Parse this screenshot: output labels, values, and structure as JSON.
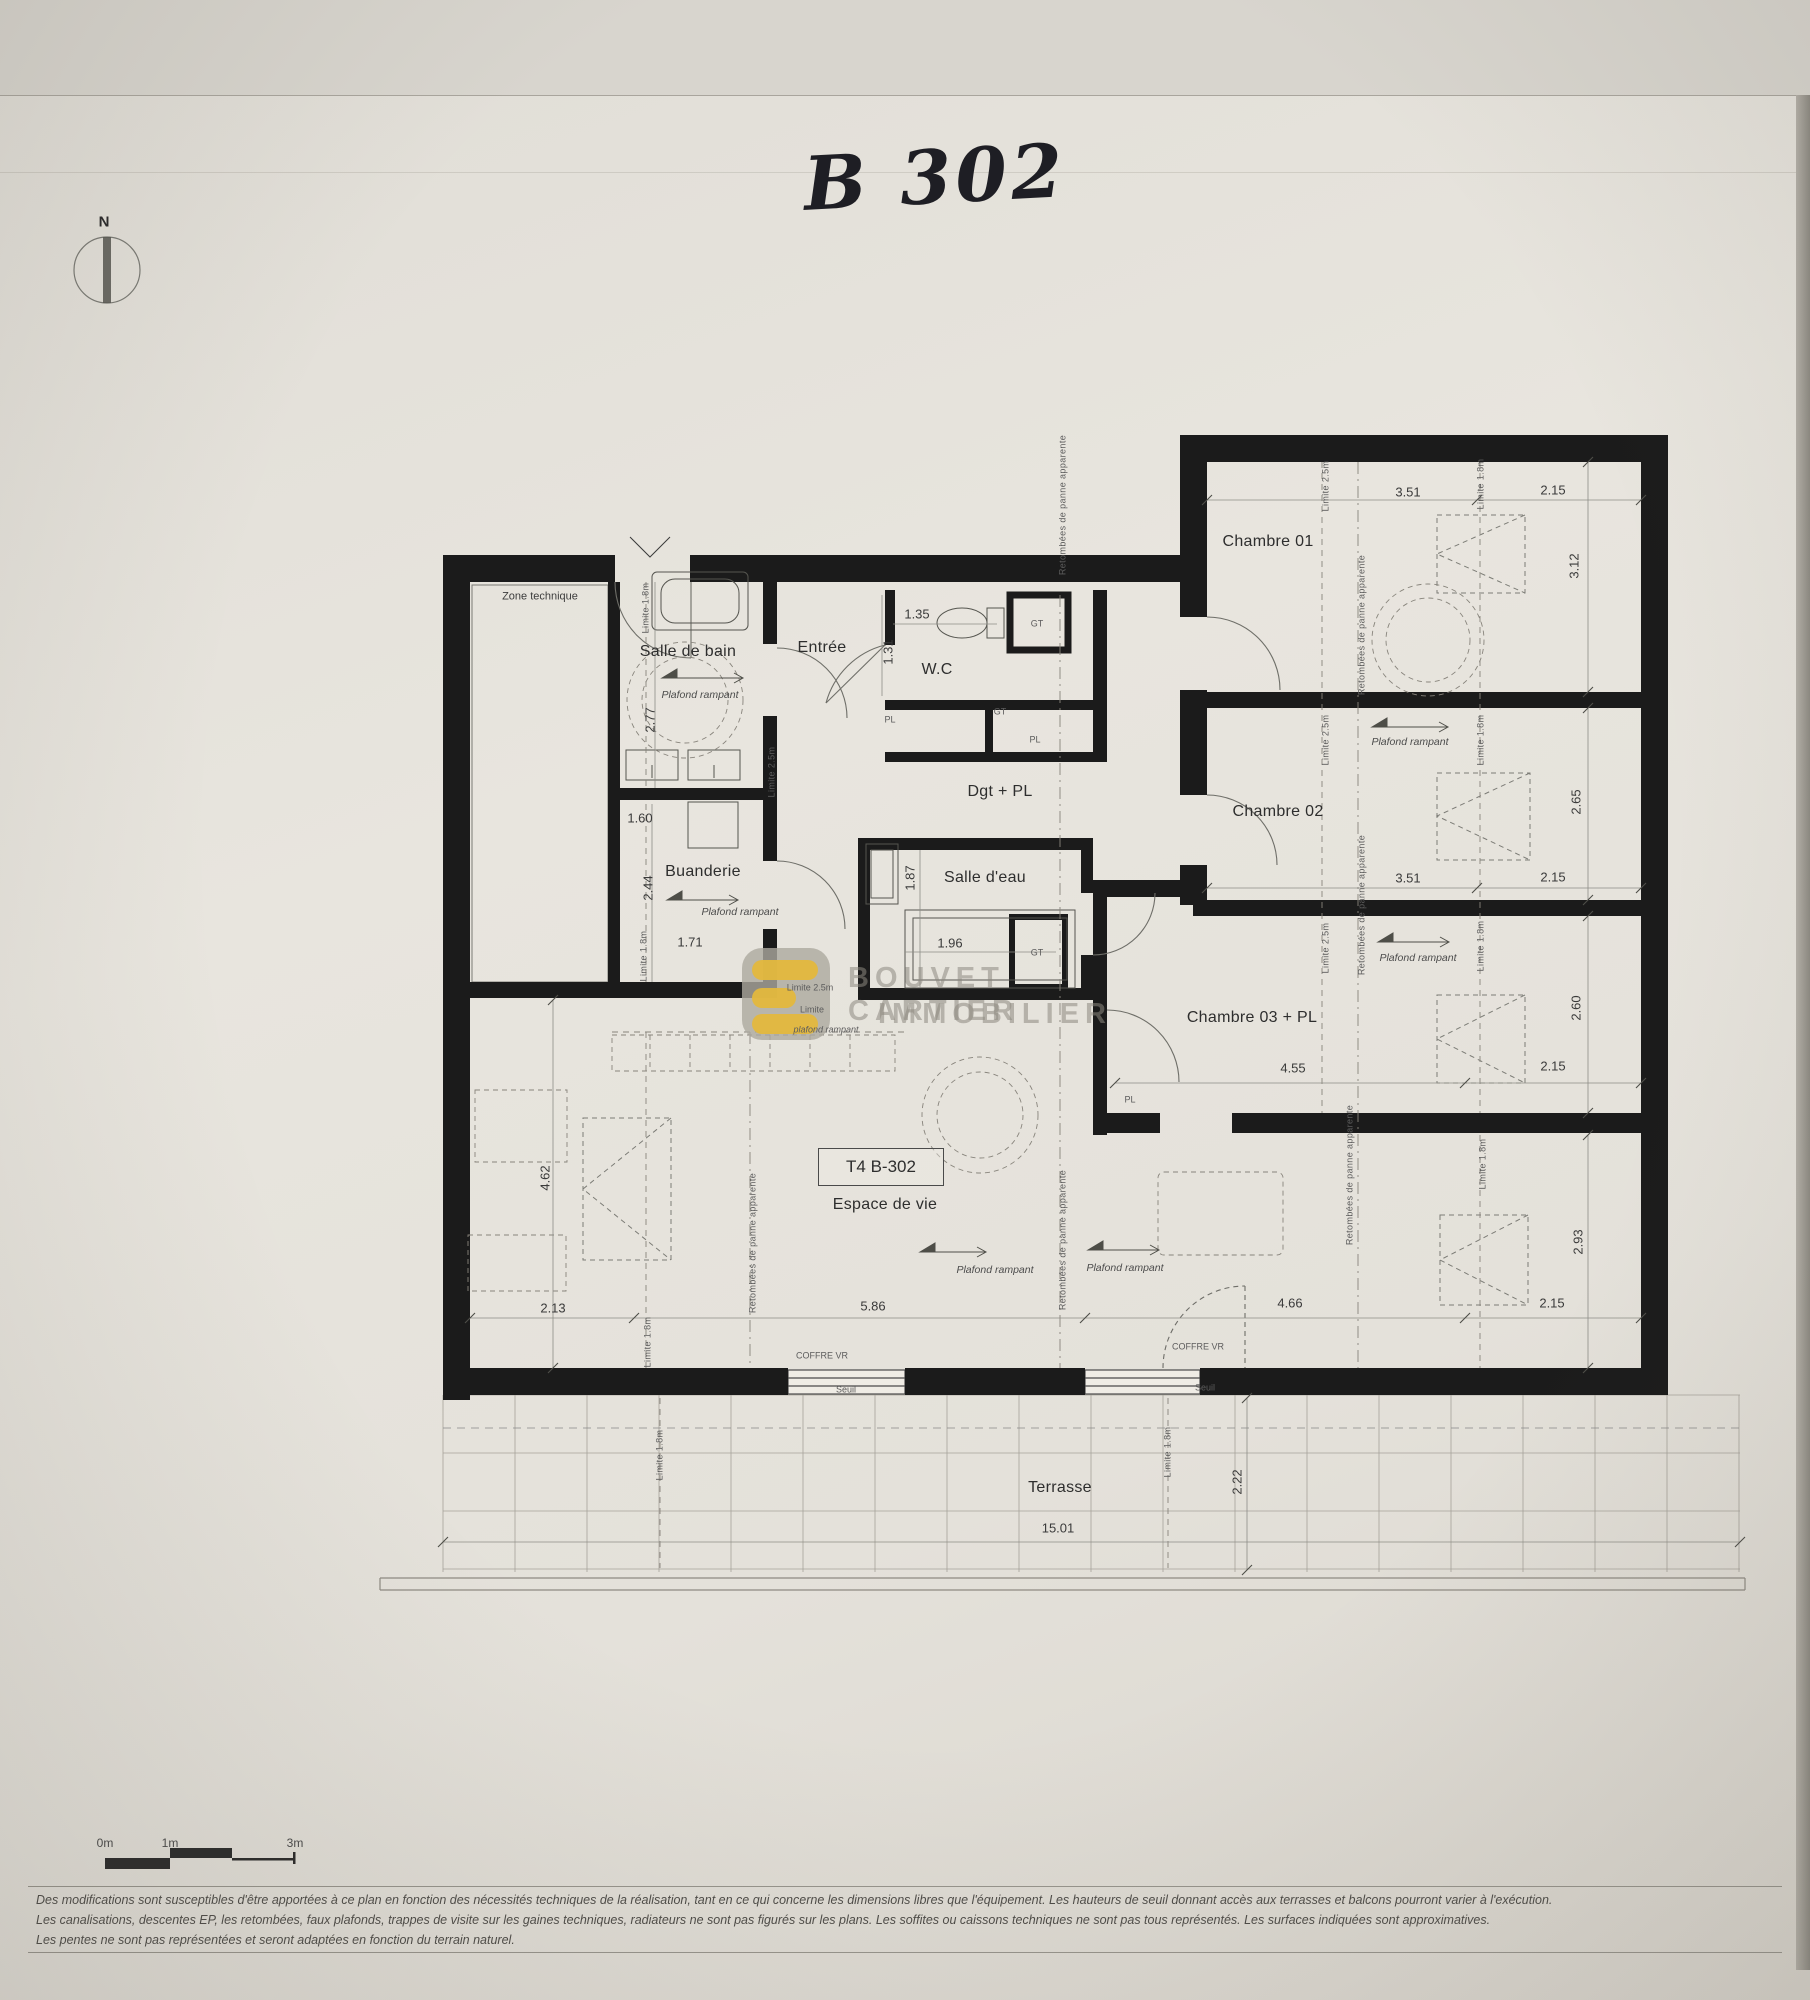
{
  "page": {
    "handwritten_unit": "B 302",
    "compass_north": "N"
  },
  "unit_box": {
    "label": "T4 B-302"
  },
  "watermark": {
    "line1": "BOUVET CARTIER",
    "line2": "IMMOBILIER"
  },
  "scalebar": {
    "zero": "0m",
    "one": "1m",
    "three": "3m"
  },
  "disclaimer": {
    "line1": "Des modifications sont susceptibles d'être apportées à ce plan en fonction des nécessités techniques de la réalisation, tant en ce qui concerne les dimensions libres que l'équipement. Les hauteurs de seuil donnant accès aux terrasses et balcons pourront varier à l'exécution.",
    "line2": "Les canalisations, descentes EP, les retombées, faux plafonds, trappes de visite sur les gaines techniques, radiateurs ne sont pas figurés sur les plans. Les soffites ou caissons techniques ne sont pas tous représentés. Les surfaces indiquées sont approximatives.",
    "line3": "Les pentes ne sont pas représentées et seront adaptées en fonction du terrain naturel."
  },
  "colors": {
    "wall": "#1b1b1b",
    "paper": "#e8e5de",
    "watermark_yellow": "#e3b83d",
    "watermark_gray": "#9a968c"
  },
  "plan": {
    "labels": [
      {
        "t": "Zone technique",
        "x": 540,
        "y": 597,
        "k": "roomsm"
      },
      {
        "t": "Salle de bain",
        "x": 688,
        "y": 652,
        "k": "room"
      },
      {
        "t": "Entrée",
        "x": 822,
        "y": 648,
        "k": "room"
      },
      {
        "t": "W.C",
        "x": 937,
        "y": 670,
        "k": "room"
      },
      {
        "t": "Dgt + PL",
        "x": 1000,
        "y": 792,
        "k": "room"
      },
      {
        "t": "Chambre 01",
        "x": 1268,
        "y": 542,
        "k": "room"
      },
      {
        "t": "Chambre 02",
        "x": 1278,
        "y": 812,
        "k": "room"
      },
      {
        "t": "Chambre 03 + PL",
        "x": 1252,
        "y": 1018,
        "k": "room"
      },
      {
        "t": "Buanderie",
        "x": 703,
        "y": 872,
        "k": "room"
      },
      {
        "t": "Salle d'eau",
        "x": 985,
        "y": 878,
        "k": "room"
      },
      {
        "t": "Espace de vie",
        "x": 885,
        "y": 1205,
        "k": "room"
      },
      {
        "t": "Terrasse",
        "x": 1060,
        "y": 1488,
        "k": "room"
      },
      {
        "t": "PL",
        "x": 890,
        "y": 720,
        "k": "tiny"
      },
      {
        "t": "GT",
        "x": 1037,
        "y": 624,
        "k": "tiny"
      },
      {
        "t": "GT",
        "x": 1000,
        "y": 712,
        "k": "tiny"
      },
      {
        "t": "PL",
        "x": 1035,
        "y": 740,
        "k": "tiny"
      },
      {
        "t": "GT",
        "x": 1037,
        "y": 953,
        "k": "tiny"
      },
      {
        "t": "PL",
        "x": 1130,
        "y": 1100,
        "k": "tiny"
      },
      {
        "t": "1.35",
        "x": 917,
        "y": 614,
        "k": "dim"
      },
      {
        "t": "1.31",
        "x": 888,
        "y": 652,
        "k": "dimv"
      },
      {
        "t": "2.77",
        "x": 650,
        "y": 720,
        "k": "dimv"
      },
      {
        "t": "1.60",
        "x": 640,
        "y": 818,
        "k": "dim"
      },
      {
        "t": "2.44",
        "x": 648,
        "y": 888,
        "k": "dimv"
      },
      {
        "t": "1.71",
        "x": 690,
        "y": 942,
        "k": "dim"
      },
      {
        "t": "1.87",
        "x": 910,
        "y": 878,
        "k": "dimv"
      },
      {
        "t": "1.96",
        "x": 950,
        "y": 943,
        "k": "dim"
      },
      {
        "t": "3.51",
        "x": 1408,
        "y": 492,
        "k": "dim"
      },
      {
        "t": "2.15",
        "x": 1553,
        "y": 490,
        "k": "dim"
      },
      {
        "t": "3.12",
        "x": 1574,
        "y": 566,
        "k": "dimv"
      },
      {
        "t": "2.65",
        "x": 1576,
        "y": 802,
        "k": "dimv"
      },
      {
        "t": "3.51",
        "x": 1408,
        "y": 878,
        "k": "dim"
      },
      {
        "t": "2.15",
        "x": 1553,
        "y": 877,
        "k": "dim"
      },
      {
        "t": "2.60",
        "x": 1576,
        "y": 1008,
        "k": "dimv"
      },
      {
        "t": "2.15",
        "x": 1553,
        "y": 1066,
        "k": "dim"
      },
      {
        "t": "4.55",
        "x": 1293,
        "y": 1068,
        "k": "dim"
      },
      {
        "t": "2.93",
        "x": 1578,
        "y": 1242,
        "k": "dimv"
      },
      {
        "t": "2.15",
        "x": 1552,
        "y": 1303,
        "k": "dim"
      },
      {
        "t": "4.62",
        "x": 545,
        "y": 1178,
        "k": "dimv"
      },
      {
        "t": "2.13",
        "x": 553,
        "y": 1308,
        "k": "dim"
      },
      {
        "t": "5.86",
        "x": 873,
        "y": 1306,
        "k": "dim"
      },
      {
        "t": "4.66",
        "x": 1290,
        "y": 1303,
        "k": "dim"
      },
      {
        "t": "15.01",
        "x": 1058,
        "y": 1528,
        "k": "dim"
      },
      {
        "t": "2.22",
        "x": 1237,
        "y": 1482,
        "k": "dimv"
      },
      {
        "t": "Plafond rampant",
        "x": 700,
        "y": 695,
        "k": "note"
      },
      {
        "t": "Plafond rampant",
        "x": 740,
        "y": 912,
        "k": "note"
      },
      {
        "t": "Plafond rampant",
        "x": 1410,
        "y": 742,
        "k": "note"
      },
      {
        "t": "Plafond rampant",
        "x": 1418,
        "y": 958,
        "k": "note"
      },
      {
        "t": "Plafond rampant",
        "x": 995,
        "y": 1270,
        "k": "note"
      },
      {
        "t": "Plafond rampant",
        "x": 1125,
        "y": 1268,
        "k": "note"
      },
      {
        "t": "Limite 1.8m",
        "x": 646,
        "y": 608,
        "k": "tinyv"
      },
      {
        "t": "Limite 2.5m",
        "x": 772,
        "y": 772,
        "k": "tinyv"
      },
      {
        "t": "Limite 1.8m",
        "x": 644,
        "y": 956,
        "k": "tinyv"
      },
      {
        "t": "Limite 2.5m",
        "x": 1326,
        "y": 486,
        "k": "tinyv"
      },
      {
        "t": "Limite 1.8m",
        "x": 1481,
        "y": 484,
        "k": "tinyv"
      },
      {
        "t": "Limite 2.5m",
        "x": 1326,
        "y": 740,
        "k": "tinyv"
      },
      {
        "t": "Limite 1.8m",
        "x": 1481,
        "y": 740,
        "k": "tinyv"
      },
      {
        "t": "Limite 2.5m",
        "x": 1326,
        "y": 948,
        "k": "tinyv"
      },
      {
        "t": "Limite 1.8m",
        "x": 1481,
        "y": 946,
        "k": "tinyv"
      },
      {
        "t": "Limite 1.8m",
        "x": 1483,
        "y": 1164,
        "k": "tinyv"
      },
      {
        "t": "Limite 1.8m",
        "x": 648,
        "y": 1342,
        "k": "tinyv"
      },
      {
        "t": "Limite 1.8m",
        "x": 660,
        "y": 1455,
        "k": "tinyv"
      },
      {
        "t": "Limite 1.8m",
        "x": 1168,
        "y": 1452,
        "k": "tinyv"
      },
      {
        "t": "Retombées de panne apparente",
        "x": 1063,
        "y": 505,
        "k": "tinyv"
      },
      {
        "t": "Retombées de panne apparente",
        "x": 1362,
        "y": 625,
        "k": "tinyv"
      },
      {
        "t": "Retombées de panne apparente",
        "x": 1362,
        "y": 905,
        "k": "tinyv"
      },
      {
        "t": "Retombées de panne apparente",
        "x": 1350,
        "y": 1175,
        "k": "tinyv"
      },
      {
        "t": "Retombées de panne apparente",
        "x": 753,
        "y": 1243,
        "k": "tinyv"
      },
      {
        "t": "Retombées de panne apparente",
        "x": 1063,
        "y": 1240,
        "k": "tinyv"
      },
      {
        "t": "COFFRE VR",
        "x": 822,
        "y": 1356,
        "k": "tiny"
      },
      {
        "t": "COFFRE VR",
        "x": 1198,
        "y": 1347,
        "k": "tiny"
      },
      {
        "t": "Seuil",
        "x": 846,
        "y": 1390,
        "k": "tiny"
      },
      {
        "t": "Seuil",
        "x": 1205,
        "y": 1388,
        "k": "tiny"
      },
      {
        "t": "Limite 2.5m",
        "x": 810,
        "y": 988,
        "k": "tiny"
      },
      {
        "t": "Limite",
        "x": 812,
        "y": 1010,
        "k": "tiny"
      },
      {
        "t": "plafond rampant",
        "x": 826,
        "y": 1030,
        "k": "tinyi"
      }
    ]
  }
}
